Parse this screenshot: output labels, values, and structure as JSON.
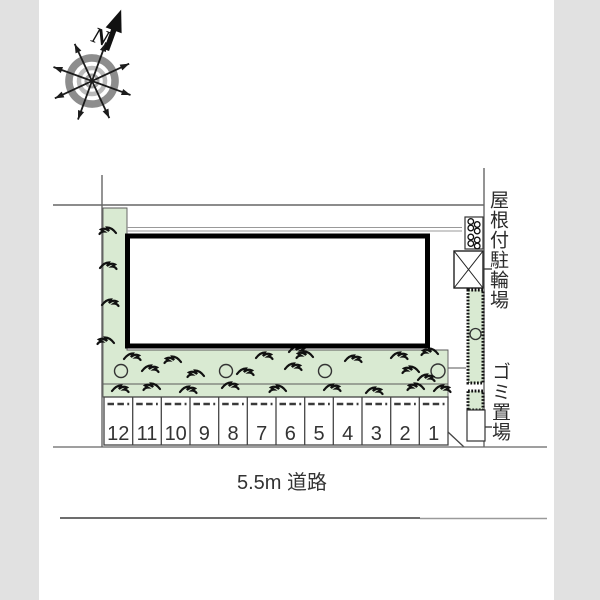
{
  "labels": {
    "north": "N",
    "covered_bicycle_parking": "屋根付駐輪場",
    "garbage_area": "ゴミ置場",
    "road": "5.5m 道路"
  },
  "parking": {
    "stalls": [
      "12",
      "11",
      "10",
      "9",
      "8",
      "7",
      "6",
      "5",
      "4",
      "3",
      "2",
      "1"
    ]
  },
  "colors": {
    "planting_green": "#d9ead2",
    "line_gray": "#666666",
    "text_dark": "#333333",
    "margin_gray": "#e1e1e1"
  }
}
